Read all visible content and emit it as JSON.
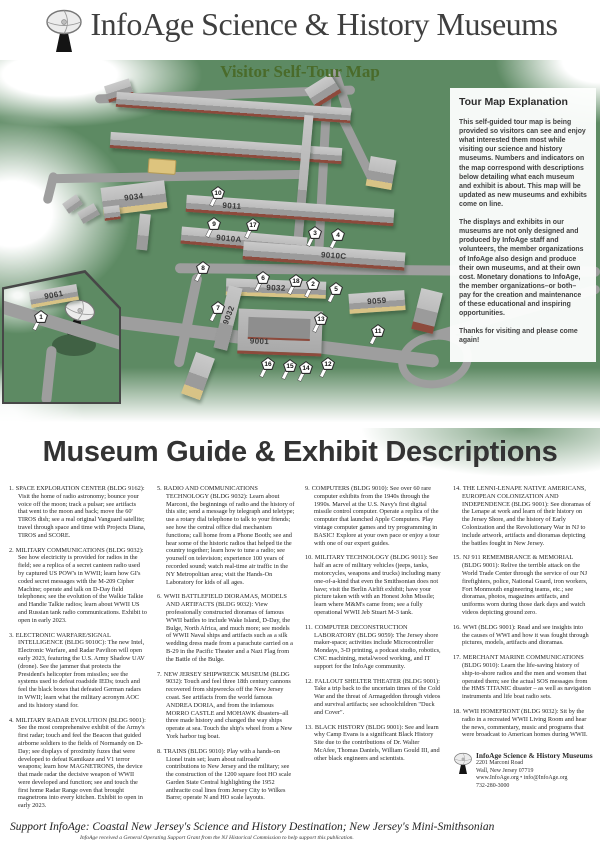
{
  "header": {
    "title": "InfoAge Science & History Museums",
    "subtitle": "Visitor Self-Tour Map"
  },
  "map": {
    "buildings": {
      "b9034": "9034",
      "b9011": "9011",
      "b9010a": "9010A",
      "b9010c": "9010C",
      "b9032": "9032",
      "b9032w": "9032",
      "b9001": "9001",
      "b9059": "9059",
      "b9061": "9061"
    },
    "pins": [
      {
        "label": "1"
      },
      {
        "label": "2"
      },
      {
        "label": "3"
      },
      {
        "label": "4"
      },
      {
        "label": "5"
      },
      {
        "label": "6"
      },
      {
        "label": "7"
      },
      {
        "label": "8"
      },
      {
        "label": "9"
      },
      {
        "label": "10"
      },
      {
        "label": "11"
      },
      {
        "label": "12"
      },
      {
        "label": "13"
      },
      {
        "label": "14"
      },
      {
        "label": "15"
      },
      {
        "label": "16"
      },
      {
        "label": "17"
      },
      {
        "label": "18"
      }
    ]
  },
  "explanation": {
    "title": "Tour Map Explanation",
    "p1": "This self-guided tour map is being provided so visitors can see and enjoy what interested them most while visiting our science and history museums. Numbers and indicators on the map correspond with descriptions below detailing what each museum and exhibit is about. This map will be updated as new museums and exhibits come on line.",
    "p2": "The displays and exhibits in our museums are not only designed and produced by InfoAge staff and volunteers, the member organizations of InfoAge also design and produce their own museums, and at their own cost. Monetary donations to InfoAge, the member organizations–or both–pay for the creation and maintenance of these educational and inspiring opportunities.",
    "p3": "Thanks for visiting and please come again!"
  },
  "guide": {
    "title": "Museum Guide & Exhibit Descriptions",
    "items": [
      {
        "num": "1.",
        "text": "SPACE EXPLORATION CENTER (BLDG 9162): Visit the home of radio astronomy; bounce your voice off the moon; track a pulsar; see artifacts that went to the moon and back; move the 60' TIROS dish; see a real original Vanguard satellite; travel through space and time with Projects Diana, TIROS and SCORE."
      },
      {
        "num": "2.",
        "text": "MILITARY COMMUNICATIONS (BLDG 9032): See how electricity is provided for radios in the field; see a replica of a secret canteen radio used by captured US POW's in WWII; learn how GI's coded secret messages with the M-209 Cipher Machine; operate and talk on D-Day field telephones; see the evolution of the Walkie Talkie and Handie Talkie radios; learn about WWII US and Russian tank radio communications. Exhibit to open in early 2023."
      },
      {
        "num": "3.",
        "text": "ELECTRONIC WARFARE/SIGNAL INTELLIGENCE (BLDG 9010C): The new Intel, Electronic Warfare, and Radar Pavilion will open early 2023, featuring the U.S. Army Shadow UAV (drone). See the jammer that protects the President's helicopter from missiles; see the systems used to defeat roadside IEDs; touch and feel the black boxes that defeated German radars in WWII; learn what the military acronym AOC and its history stand for."
      },
      {
        "num": "4.",
        "text": "MILITARY RADAR EVOLUTION (BLDG 9001): See the most comprehensive exhibit of the Army's first radar; touch and feel the Beacon that guided airborne soldiers to the fields of Normandy on D-Day; see displays of proximity fuzes that were developed to defeat Kamikaze and V1 terror weapons; learn how MAGNETRONS, the device that made radar the decisive weapon of WWII were developed and function; see and touch the first home Radar Range oven that brought magnetrons into every kitchen. Exhibit to open in early 2023."
      },
      {
        "num": "5.",
        "text": "RADIO AND COMMUNICATIONS TECHNOLOGY (BLDG 9032): Learn about Marconi, the beginnings of radio and the history of this site; send a message by telegraph and teletype; use a rotary dial telephone to talk to your friends; see how the central office dial mechanism functions; call home from a Phone Booth; see and hear some of the historic radios that helped tie the country together; learn how to tune a radio; see yourself on television; experience 100 years of recorded sound; watch real-time air traffic in the NY Metropolitan area; visit the Hands-On Laboratory for kids of all ages."
      },
      {
        "num": "6.",
        "text": "WWII BATTLEFIELD DIORAMAS, MODELS AND ARTIFACTS (BLDG 9032): View professionally constructed dioramas of famous WWII battles to include Wake Island, D-Day, the Bulge, North Africa, and much more; see models of WWII Naval ships and artifacts such as a silk wedding dress made from a parachute carried on a B-29 in the Pacific Theater and a Nazi Flag from the Battle of the Bulge."
      },
      {
        "num": "7.",
        "text": "NEW JERSEY SHIPWRECK MUSEUM (BLDG 9032): Touch and feel three 18th century cannons recovered from shipwrecks off the New Jersey coast. See artifacts from the world famous ANDREA DORIA, and from the infamous MORRO CASTLE and MOHAWK disasters–all three made history and changed the way ships operate at sea. Touch the ship's wheel from a New York harbor tug boat."
      },
      {
        "num": "8.",
        "text": "TRAINS (BLDG 9010): Play with a hands-on Lionel train set; learn about railroads' contributions to New Jersey and the military; see the construction of the 1200 square foot HO scale Garden State Central highlighting the 1952 anthracite coal lines from Jersey City to Wilkes Barre; operate N and HO scale layouts."
      },
      {
        "num": "9.",
        "text": "COMPUTERS (BLDG 9010): See over 60 rare computer exhibits from the 1940s through the 1990s. Marvel at the U.S. Navy's first digital missile control computer. Operate a replica of the computer that launched Apple Computers. Play vintage computer games and try programming in BASIC! Explore at your own pace or enjoy a tour with one of our expert guides."
      },
      {
        "num": "10.",
        "text": "MILITARY TECHNOLOGY (BLDG 9011): See half an acre of military vehicles (jeeps, tanks, motorcycles, weapons and trucks) including many one-of-a-kind that even the Smithsonian does not have; visit the Berlin Airlift exhibit; have your picture taken with with an Honest John Missile; learn where M&M's came from; see a fully operational WWII Jeb Stuart M-3 tank."
      },
      {
        "num": "11.",
        "text": "COMPUTER DECONSTRUCTION LABORATORY (BLDG 9059): The Jersey shore maker-space; activities include Microcontroller Mondays, 3-D printing, a podcast studio, robotics, CNC machining, metal/wood working, and IT support for the InfoAge community."
      },
      {
        "num": "12.",
        "text": "FALLOUT SHELTER THEATER (BLDG 9001): Take a trip back to the uncertain times of the Cold War and the threat of Armageddon through videos and survival artifacts; see schoolchildren \"Duck and Cover\"."
      },
      {
        "num": "13.",
        "text": "BLACK HISTORY (BLDG 9001): See and learn why Camp Evans is a significant Black History Site due to the contributions of Dr. Walter McAfee, Thomas Daniels, William Gould III, and other black engineers and scientists."
      },
      {
        "num": "14.",
        "text": "THE LENNI-LENAPE NATIVE AMERICANS, EUROPEAN COLONIZATION AND INDEPENDENCE (BLDG 9001): See dioramas of the Lenape at work and learn of their history on the Jersey Shore, and the history of Early Colonization and the Revolutionary War in NJ to include artwork, artifacts and dioramas depicting the battles fought in New Jersey."
      },
      {
        "num": "15.",
        "text": "NJ 911 REMEMBRANCE & MEMORIAL (BLDG 9001): Relive the terrible attack on the World Trade Center through the service of our NJ firefighters, police, National Guard, iron workers, Fort Monmouth engineering teams, etc.; see dioramas, photos, magazines artifacts, and uniforms worn during those dark days and watch videos depicting ground zero."
      },
      {
        "num": "16.",
        "text": "WWI (BLDG 9001): Read and see insights into the causes of WWI and how it was fought through pictures, models, artifacts and dioramas."
      },
      {
        "num": "17.",
        "text": "MERCHANT MARINE COMMUNICATIONS (BLDG 9010): Learn the life-saving history of ship-to-shore radios and the men and women that operated them; see the actual SOS messages from the HMS TITANIC disaster – as well as navigation instruments and life boat radio sets."
      },
      {
        "num": "18.",
        "text": "WWII HOMEFRONT (BLDG 9032): Sit by the radio in a recreated WWII Living Room and hear the news, commentary, music and programs that were broadcast to American homes during WWII."
      }
    ]
  },
  "contact": {
    "name": "InfoAge Science & History Museums",
    "address1": "2201 Marconi Road",
    "address2": "Wall, New Jersey 07719",
    "web": "www.InfoAge.org • info@InfoAge.org",
    "phone": "732-280-3000"
  },
  "footer": {
    "tagline": "Support InfoAge: Coastal New Jersey's Science and History Destination; New Jersey's Mini-Smithsonian",
    "grant": "InfoAge received a General Operating Support Grant from the NJ Historical Commission to help support this publication."
  }
}
